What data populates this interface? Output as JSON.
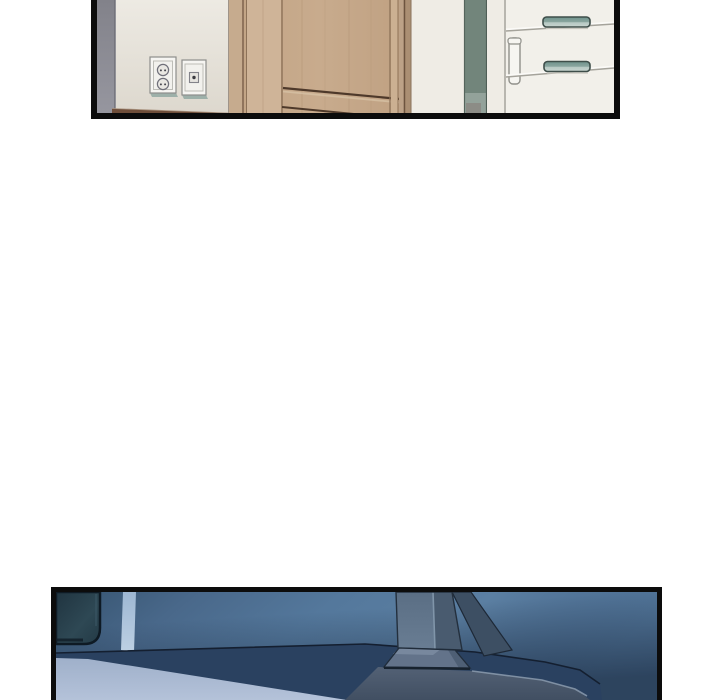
{
  "page": {
    "kind": "webtoon-comic-page",
    "visible_text": [],
    "panel_count": 2
  },
  "panels": [
    {
      "id": "panel-top",
      "description": "Interior room: gray wall corner, beige wall with a two-socket power outlet and a switch plate, light wooden wardrobe door, dark teal gap, white drawer cabinet with teal handles"
    },
    {
      "id": "panel-bottom",
      "description": "Dim blue room: back of a monitor on the left, monitor stand and base on a dark desk, lit periwinkle desk surface in the foreground"
    }
  ],
  "palette": {
    "page_bg": "#ffffff",
    "panel_border": "#0c0c0c",
    "wall_gray": "#8b8b94",
    "wall_beige": "#ebe8e1",
    "floor_brown": "#6f4e3a",
    "wood_main": "#c2a485",
    "wood_light": "#cfb498",
    "wood_dark_line": "#4e392a",
    "plate_white": "#f6f5f2",
    "plate_shadow_teal": "#9db0a9",
    "teal_gap": "#72857b",
    "cabinet_white": "#f2f0ea",
    "cabinet_line": "#a5a39b",
    "handle_teal": "#7fa29b",
    "handle_outline": "#3e4e4a",
    "wall_blue_mid": "#54789c",
    "wall_blue_dark": "#26394f",
    "monitor_dark": "#28404d",
    "strip_light_blue": "#a9c0d8",
    "desk_shadow_navy": "#2a4160",
    "desk_lit_periwinkle": "#a6b5cf",
    "desk_front_gray": "#4d5b6f",
    "stand_gray": "#5e7288"
  }
}
